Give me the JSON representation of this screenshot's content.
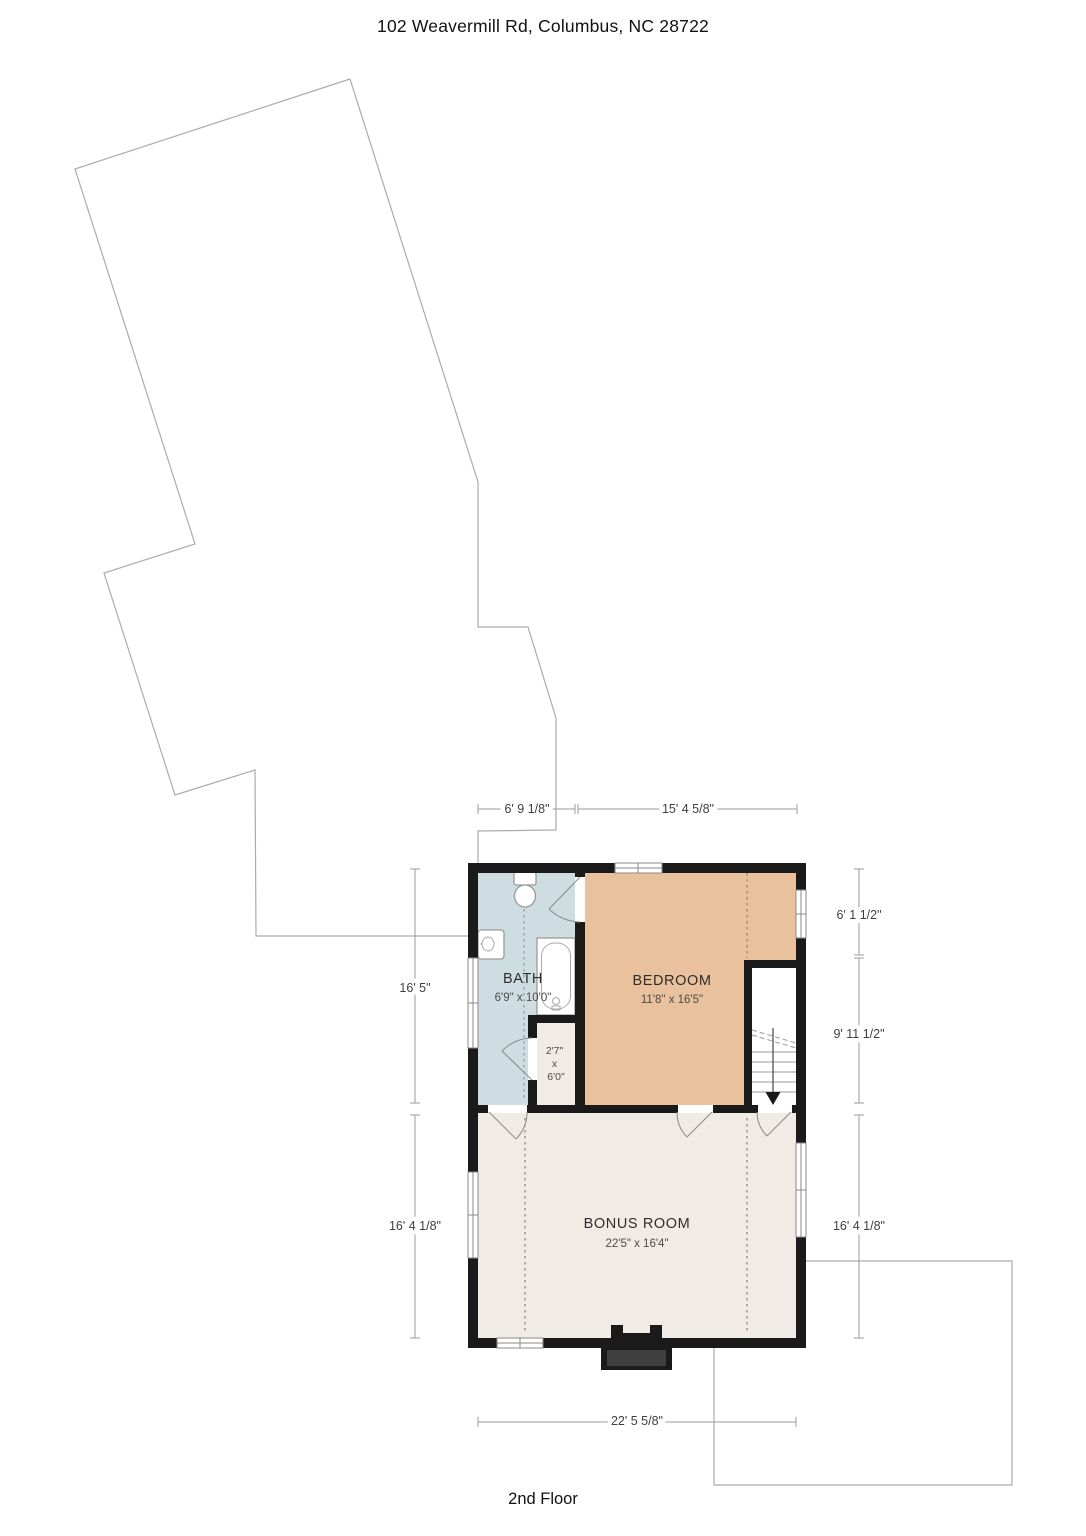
{
  "header": {
    "address": "102 Weavermill Rd, Columbus, NC 28722"
  },
  "footer": {
    "floor_label": "2nd Floor"
  },
  "rooms": [
    {
      "id": "bath",
      "name": "BATH",
      "size": "6'9\" x 10'0\""
    },
    {
      "id": "bedroom",
      "name": "BEDROOM",
      "size": "11'8\" x 16'5\""
    },
    {
      "id": "closet",
      "name_lines": [
        "2'7\"",
        "x",
        "6'0\""
      ]
    },
    {
      "id": "bonus",
      "name": "BONUS ROOM",
      "size": "22'5\" x 16'4\""
    }
  ],
  "dimensions": {
    "top_left": "6' 9 1/8\"",
    "top_right": "15' 4 5/8\"",
    "left_upper": "16' 5\"",
    "left_lower": "16' 4 1/8\"",
    "right_upper": "6' 1 1/2\"",
    "right_middle": "9' 11 1/2\"",
    "right_lower": "16' 4 1/8\"",
    "bottom": "22' 5 5/8\""
  },
  "colors": {
    "walls": "#1a1a1a",
    "bath": "#cddde1",
    "bedroom": "#e9c19c",
    "bonus": "#f0ebe4",
    "stairwell": "#ffffff",
    "outline": "#ababab",
    "chimney_inner": "#3f3f3f"
  }
}
